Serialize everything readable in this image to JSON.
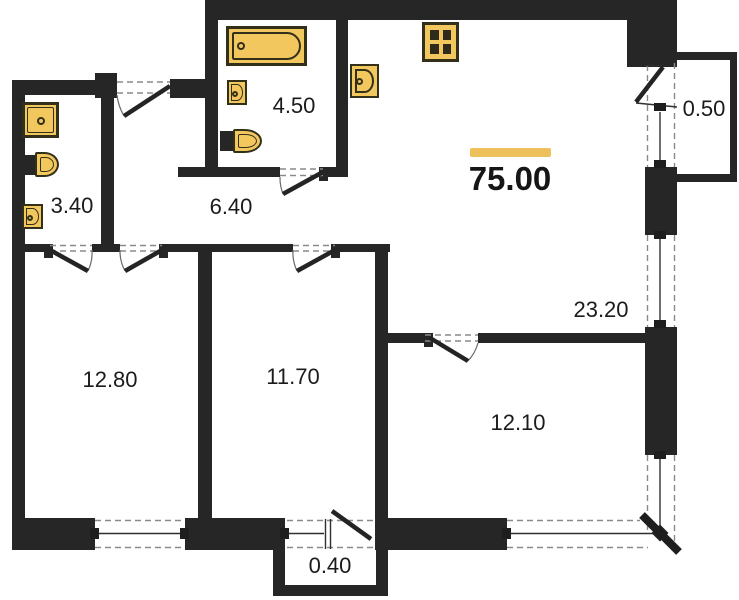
{
  "plan": {
    "title": "apartment-floor-plan",
    "total_area_label": "75.00",
    "rooms": [
      {
        "name": "bathroom-small",
        "area": "3.40"
      },
      {
        "name": "hallway",
        "area": "6.40"
      },
      {
        "name": "bathroom-main",
        "area": "4.50"
      },
      {
        "name": "balcony-right",
        "area": "0.50"
      },
      {
        "name": "kitchen-living",
        "area": "23.20"
      },
      {
        "name": "bedroom-left",
        "area": "12.80"
      },
      {
        "name": "bedroom-middle",
        "area": "11.70"
      },
      {
        "name": "room-right",
        "area": "12.10"
      },
      {
        "name": "balcony-bottom",
        "area": "0.40"
      }
    ],
    "fixtures": [
      "bathtub",
      "stove-4-burner",
      "kitchen-sink",
      "sink",
      "toilet",
      "washing-machine"
    ],
    "colors": {
      "wall": "#262626",
      "fixture_fill": "#f2c75e",
      "fixture_stroke": "#33301a",
      "accent_bar": "#eec05b",
      "text": "#1b1b1b",
      "dash_line": "#8a8a8a",
      "window_line": "#2f2f2f"
    }
  }
}
